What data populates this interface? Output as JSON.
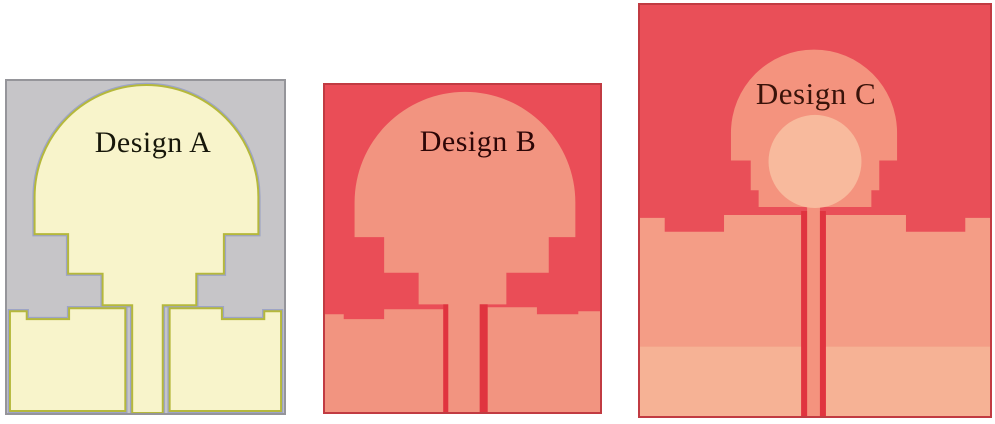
{
  "figure": {
    "type": "antenna-design-evolution",
    "panels": [
      {
        "id": "design-a",
        "label": "Design A",
        "colors": {
          "background": "#c6c5c8",
          "border": "#95959a",
          "patch": "#f8f4cb",
          "outline": "#b5b83c",
          "halo": "#9da4c6",
          "label": "#17170a"
        }
      },
      {
        "id": "design-b",
        "label": "Design B",
        "colors": {
          "background": "#ea4d57",
          "border": "#c13b42",
          "patch": "#f29480",
          "gap_line": "#e0343f",
          "label": "#2d0606"
        }
      },
      {
        "id": "design-c",
        "label": "Design C",
        "colors": {
          "background": "#e94f58",
          "border": "#c13b42",
          "patch": "#f4937e",
          "ground": "#f49d86",
          "band": "#f6b295",
          "circle": "#f8ba9d",
          "gap_line": "#e0343f",
          "label": "#3a130a"
        }
      }
    ]
  }
}
